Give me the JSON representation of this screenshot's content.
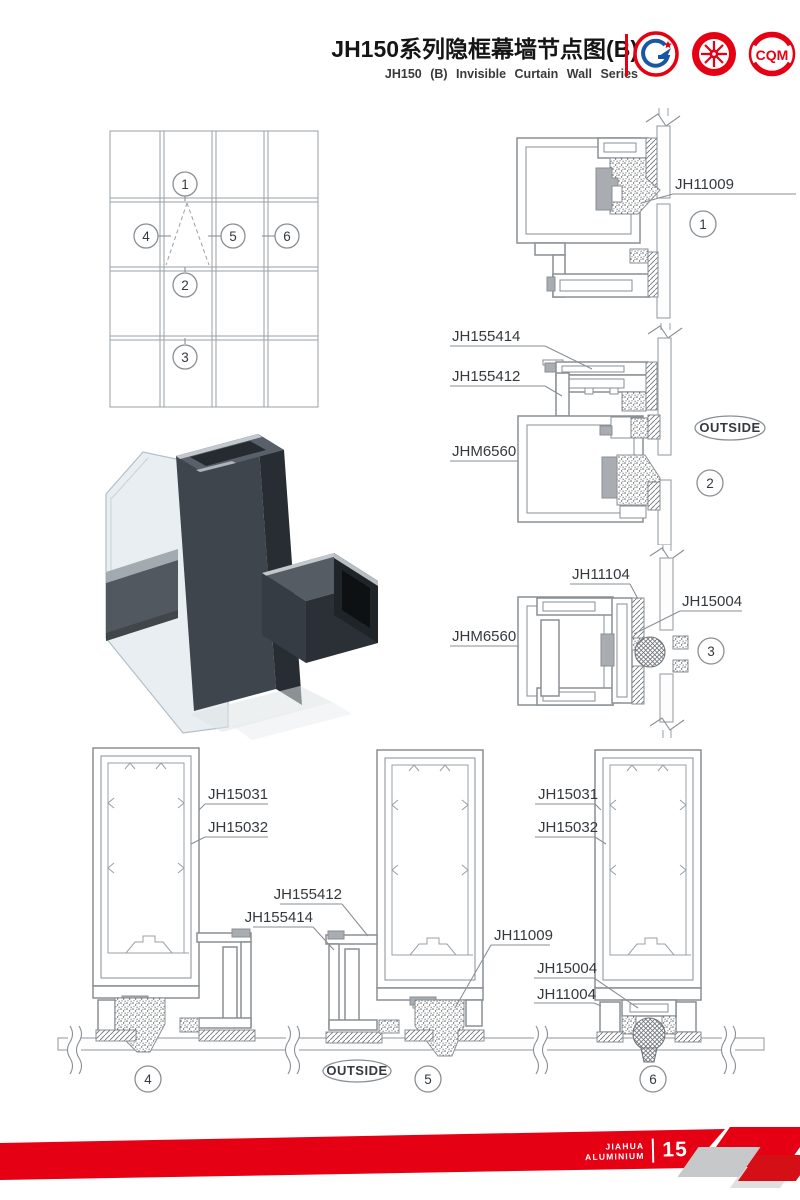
{
  "colors": {
    "accent_red": "#e60013",
    "line_gray": "#8a8f94"
  },
  "header": {
    "title_cn": "JH150系列隐框幕墙节点图(B)",
    "title_en": "JH150 (B) Invisible Curtain Wall Series",
    "logo_gb": "GB",
    "logo_cqm": "CQM"
  },
  "elevation": {
    "callout_1": "1",
    "callout_2": "2",
    "callout_3": "3",
    "callout_4": "4",
    "callout_5": "5",
    "callout_6": "6"
  },
  "detail_1": {
    "num": "1",
    "label_jh11009": "JH11009"
  },
  "detail_2": {
    "num": "2",
    "label_jh155414": "JH155414",
    "label_jh155412": "JH155412",
    "label_jhm6560": "JHM6560",
    "outside": "OUTSIDE"
  },
  "detail_3": {
    "num": "3",
    "label_jh11104": "JH11104",
    "label_jh15004": "JH15004",
    "label_jhm6560": "JHM6560"
  },
  "detail_4": {
    "num": "4",
    "label_jh15031": "JH15031",
    "label_jh15032": "JH15032"
  },
  "detail_5": {
    "num": "5",
    "label_jh155412": "JH155412",
    "label_jh155414": "JH155414",
    "label_jh11009": "JH11009",
    "outside": "OUTSIDE"
  },
  "detail_6": {
    "num": "6",
    "label_jh15031": "JH15031",
    "label_jh15032": "JH15032",
    "label_jh15004": "JH15004",
    "label_jh11004": "JH11004"
  },
  "footer": {
    "brand_line1": "JIAHUA",
    "brand_line2": "ALUMINIUM",
    "page_number": "15"
  }
}
